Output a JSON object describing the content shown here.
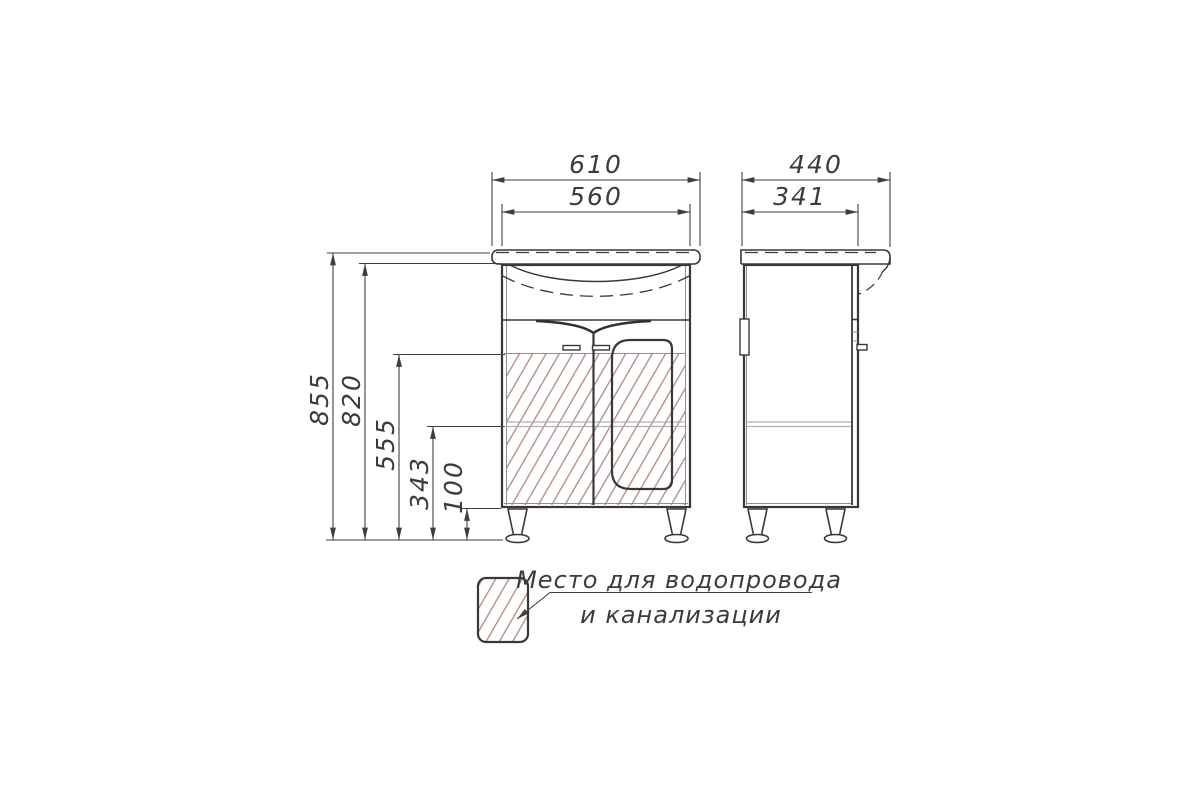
{
  "dimensions": {
    "front": {
      "total_width": "610",
      "cabinet_width": "560"
    },
    "side": {
      "total_depth": "440",
      "cabinet_depth": "341"
    },
    "heights": {
      "total": "855",
      "cabinet": "820",
      "plumbing_top": "555",
      "shelf": "343",
      "legs": "100"
    }
  },
  "legend": {
    "line1": "Место для водопровода",
    "line2": "и канализации"
  },
  "colors": {
    "line": "#3f3f3f",
    "hatch": "#ad8a7e",
    "shelf": "#b0b0b0",
    "background": "#ffffff"
  }
}
